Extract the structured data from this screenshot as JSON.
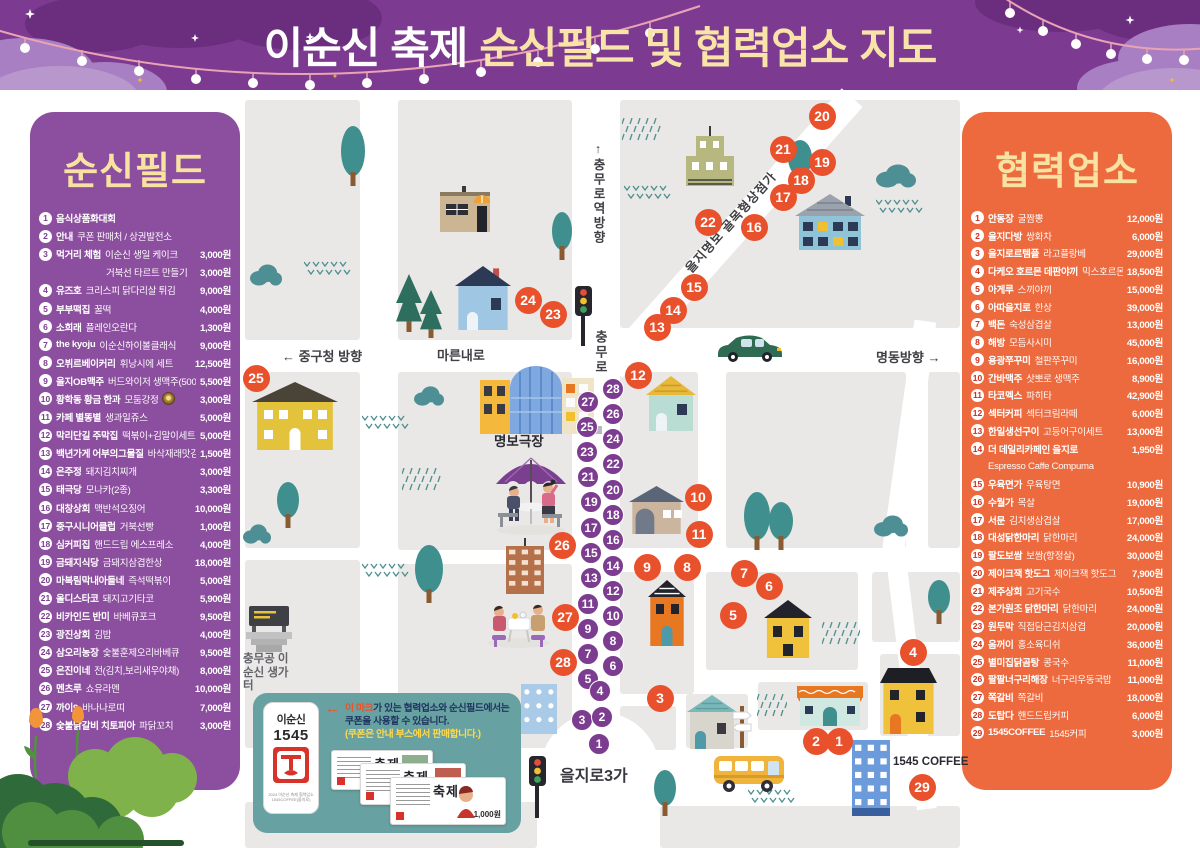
{
  "header": {
    "title_white": "이순신 축제",
    "title_yellow": "순신필드 및 협력업소 지도"
  },
  "colors": {
    "header_bg": "#7d3a91",
    "field_panel_bg": "#8c4e9e",
    "partner_panel_bg": "#ed6a3e",
    "title_yellow": "#f8e2a2",
    "marker_orange": "#e8512c",
    "marker_purple": "#7c3d90",
    "coupon_box_bg": "#68a1a1"
  },
  "field_panel": {
    "title": "순신필드",
    "items": [
      {
        "n": "1",
        "name": "음식상품화대회",
        "desc": "",
        "price": ""
      },
      {
        "n": "2",
        "name": "안내",
        "desc": "쿠폰 판매처 / 상권발전소",
        "price": ""
      },
      {
        "n": "3",
        "name": "먹거리 체험",
        "desc": "이순신 생일 케이크",
        "price": "3,000원"
      },
      {
        "indent": true,
        "n": "",
        "name": "",
        "desc": "거북선 타르트 만들기",
        "price": "3,000원"
      },
      {
        "n": "4",
        "name": "유즈호",
        "desc": "크리스피 닭다리살 튀김",
        "price": "9,000원"
      },
      {
        "n": "5",
        "name": "부부떡집",
        "desc": "꿀떡",
        "price": "4,000원"
      },
      {
        "n": "6",
        "name": "소희래",
        "desc": "플레인오란다",
        "price": "1,300원"
      },
      {
        "n": "7",
        "name": "the kyoju",
        "desc": "이순신하이볼클래식",
        "price": "9,000원"
      },
      {
        "n": "8",
        "name": "오뷔르베이커리",
        "desc": "휘낭시에 세트",
        "price": "12,500원"
      },
      {
        "n": "9",
        "name": "을지OB맥주",
        "desc": "버드와이저 생맥주(500cc)",
        "price": "5,500원"
      },
      {
        "n": "10",
        "name": "황학동 황금 한과",
        "desc": "모둠강정",
        "price": "3,000원",
        "badge": true
      },
      {
        "n": "11",
        "name": "카페 별똥별",
        "desc": "생과일쥬스",
        "price": "5,000원"
      },
      {
        "n": "12",
        "name": "막리단길 주막집",
        "desc": "떡볶이+김말이세트",
        "price": "5,000원"
      },
      {
        "n": "13",
        "name": "백년가게 어부의그물질",
        "desc": "바삭재래맛김",
        "price": "1,500원"
      },
      {
        "n": "14",
        "name": "은주정",
        "desc": "돼지김치찌개",
        "price": "3,000원"
      },
      {
        "n": "15",
        "name": "태극당",
        "desc": "모나카(2종)",
        "price": "3,300원"
      },
      {
        "n": "16",
        "name": "대창상회",
        "desc": "맥반석오징어",
        "price": "10,000원"
      },
      {
        "n": "17",
        "name": "중구시니어클럽",
        "desc": "거북선빵",
        "price": "1,000원"
      },
      {
        "n": "18",
        "name": "심커피집",
        "desc": "핸드드립 에스프레소",
        "price": "4,000원"
      },
      {
        "n": "19",
        "name": "금돼지식당",
        "desc": "금돼지삼겹한상",
        "price": "18,000원"
      },
      {
        "n": "20",
        "name": "마복림막내아들네",
        "desc": "즉석떡볶이",
        "price": "5,000원"
      },
      {
        "n": "21",
        "name": "올디스타코",
        "desc": "돼지고기타코",
        "price": "5,900원"
      },
      {
        "n": "22",
        "name": "비카인드 반미",
        "desc": "바베큐포크",
        "price": "9,500원"
      },
      {
        "n": "23",
        "name": "광진상회",
        "desc": "김밥",
        "price": "4,000원"
      },
      {
        "n": "24",
        "name": "삼오리농장",
        "desc": "숯불훈제오리바베큐",
        "price": "9,500원"
      },
      {
        "n": "25",
        "name": "은진이네",
        "desc": "전(김치,보리새우야채)",
        "price": "8,000원"
      },
      {
        "n": "26",
        "name": "멘츠루",
        "desc": "쇼유라멘",
        "price": "10,000원"
      },
      {
        "n": "27",
        "name": "까이9",
        "desc": "바나나로띠",
        "price": "7,000원"
      },
      {
        "n": "28",
        "name": "숯불닭갈비 치토피아",
        "desc": "파닭꼬치",
        "price": "3,000원"
      }
    ]
  },
  "partner_panel": {
    "title": "협력업소",
    "items": [
      {
        "n": "1",
        "name": "안동장",
        "desc": "굴짬뽕",
        "price": "12,000원"
      },
      {
        "n": "2",
        "name": "을지다방",
        "desc": "쌍화차",
        "price": "6,000원"
      },
      {
        "n": "3",
        "name": "을지로르템플",
        "desc": "라고플랑베",
        "price": "29,000원"
      },
      {
        "n": "4",
        "name": "다케오 호르몬 데판야끼",
        "desc": "믹스호르몬",
        "price": "18,500원"
      },
      {
        "n": "5",
        "name": "아게루",
        "desc": "스끼야끼",
        "price": "15,000원"
      },
      {
        "n": "6",
        "name": "아따을지로",
        "desc": "한상",
        "price": "39,000원"
      },
      {
        "n": "7",
        "name": "백돈",
        "desc": "숙성삼겹살",
        "price": "13,000원"
      },
      {
        "n": "8",
        "name": "해방",
        "desc": "모듬사시미",
        "price": "45,000원"
      },
      {
        "n": "9",
        "name": "용광쭈꾸미",
        "desc": "철판쭈꾸미",
        "price": "16,000원"
      },
      {
        "n": "10",
        "name": "간바맥주",
        "desc": "삿뽀로 생맥주",
        "price": "8,900원"
      },
      {
        "n": "11",
        "name": "타코멕스",
        "desc": "파히타",
        "price": "42,900원"
      },
      {
        "n": "12",
        "name": "섹터커피",
        "desc": "섹터크림라떼",
        "price": "6,000원"
      },
      {
        "n": "13",
        "name": "한일생선구이",
        "desc": "고등어구이세트",
        "price": "13,000원"
      },
      {
        "n": "14",
        "name": "더 데일리카페인 을지로",
        "desc": "",
        "price": "1,950원"
      },
      {
        "indent": true,
        "n": "",
        "name": "",
        "desc": "Espresso Caffe Compuma",
        "price": ""
      },
      {
        "n": "15",
        "name": "우육면가",
        "desc": "우육탕면",
        "price": "10,900원"
      },
      {
        "n": "16",
        "name": "수월가",
        "desc": "목살",
        "price": "19,000원"
      },
      {
        "n": "17",
        "name": "서문",
        "desc": "김치생삼겹살",
        "price": "17,000원"
      },
      {
        "n": "18",
        "name": "대성닭한마리",
        "desc": "닭한마리",
        "price": "24,000원"
      },
      {
        "n": "19",
        "name": "팔도보쌈",
        "desc": "보쌈(항정살)",
        "price": "30,000원"
      },
      {
        "n": "20",
        "name": "제이크잭 핫도그",
        "desc": "제이크잭 핫도그",
        "price": "7,900원"
      },
      {
        "n": "21",
        "name": "제주상회",
        "desc": "고기국수",
        "price": "10,500원"
      },
      {
        "n": "22",
        "name": "본가원조 닭한마리",
        "desc": "닭한마리",
        "price": "24,000원"
      },
      {
        "n": "23",
        "name": "원두막",
        "desc": "직접담근김치삼겹",
        "price": "20,000원"
      },
      {
        "n": "24",
        "name": "옴꺼이",
        "desc": "홍소육디쉬",
        "price": "36,000원"
      },
      {
        "n": "25",
        "name": "별미집닭곰탕",
        "desc": "콩국수",
        "price": "11,000원"
      },
      {
        "n": "26",
        "name": "팔팔너구리해장",
        "desc": "너구리우동국밥",
        "price": "11,000원"
      },
      {
        "n": "27",
        "name": "쪽갈비",
        "desc": "쪽갈비",
        "price": "18,000원"
      },
      {
        "n": "28",
        "name": "도탑다",
        "desc": "핸드드립커피",
        "price": "6,000원"
      },
      {
        "n": "29",
        "name": "1545COFFEE",
        "desc": "1545커피",
        "price": "3,000원"
      }
    ]
  },
  "map": {
    "labels": {
      "chungmuro_station": "↑충무로역방향",
      "chungmuro": "충무로",
      "mareunnae": "마른내로",
      "junggu_direction": "← 중구청 방향",
      "alley": "을지명보 골목형상점가",
      "myeongdong_direction": "명동방향 →",
      "myeongbo_theater": "명보극장",
      "birthplace": "충무공 이순신 생가터",
      "euljiro3ga": "을지로3가",
      "coffee_1545": "1545 COFFEE"
    },
    "purple_markers": [
      [
        28,
        613,
        389
      ],
      [
        27,
        588,
        402
      ],
      [
        26,
        613,
        414
      ],
      [
        25,
        587,
        427
      ],
      [
        24,
        613,
        439
      ],
      [
        23,
        587,
        452
      ],
      [
        22,
        613,
        464
      ],
      [
        21,
        588,
        477
      ],
      [
        20,
        613,
        490
      ],
      [
        19,
        591,
        502
      ],
      [
        18,
        613,
        515
      ],
      [
        17,
        591,
        528
      ],
      [
        16,
        613,
        540
      ],
      [
        15,
        591,
        553
      ],
      [
        14,
        613,
        566
      ],
      [
        13,
        591,
        578
      ],
      [
        12,
        613,
        591
      ],
      [
        11,
        588,
        604
      ],
      [
        10,
        613,
        616
      ],
      [
        9,
        588,
        629
      ],
      [
        8,
        613,
        641
      ],
      [
        7,
        588,
        654
      ],
      [
        6,
        613,
        666
      ],
      [
        5,
        588,
        679
      ],
      [
        4,
        600,
        691
      ],
      [
        3,
        582,
        720
      ],
      [
        2,
        602,
        717
      ],
      [
        1,
        599,
        744
      ]
    ],
    "orange_markers": [
      [
        20,
        822,
        116
      ],
      [
        21,
        783,
        149
      ],
      [
        19,
        822,
        162
      ],
      [
        18,
        801,
        180
      ],
      [
        17,
        783,
        197
      ],
      [
        22,
        708,
        222
      ],
      [
        16,
        754,
        227
      ],
      [
        15,
        694,
        287
      ],
      [
        14,
        673,
        310
      ],
      [
        13,
        657,
        327
      ],
      [
        24,
        528,
        300
      ],
      [
        23,
        553,
        314
      ],
      [
        25,
        256,
        378
      ],
      [
        12,
        638,
        375
      ],
      [
        10,
        698,
        497
      ],
      [
        11,
        699,
        534
      ],
      [
        26,
        562,
        545
      ],
      [
        9,
        647,
        567
      ],
      [
        8,
        687,
        567
      ],
      [
        7,
        744,
        573
      ],
      [
        6,
        769,
        586
      ],
      [
        5,
        733,
        615
      ],
      [
        27,
        565,
        617
      ],
      [
        4,
        913,
        652
      ],
      [
        28,
        563,
        662
      ],
      [
        3,
        660,
        698
      ],
      [
        2,
        816,
        741
      ],
      [
        1,
        839,
        741
      ],
      [
        29,
        922,
        787
      ]
    ]
  },
  "coupon_box": {
    "arrow": "←",
    "highlight": "이 마크",
    "line1": "가 있는 협력업소와 순신필드에서는",
    "line2": "쿠폰을 사용할 수 있습니다.",
    "line3": "(쿠폰은 안내 부스에서 판매합니다.)",
    "logo_name": "이순신",
    "logo_num": "1545",
    "caption1": "2024 이순신 축제 협력업소",
    "caption2": "1545COFFEE(을지로)",
    "ticket_label": "축제",
    "coupon_price": "1,000원"
  }
}
